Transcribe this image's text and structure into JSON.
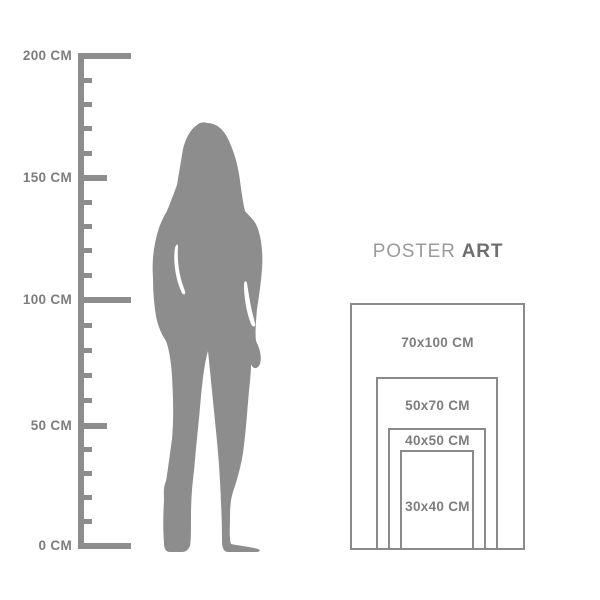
{
  "colors": {
    "shape_gray": "#8d8d8d",
    "rect_border_gray": "#8a8a8a",
    "label_text_gray": "#7d7d7d",
    "brand_regular_gray": "#9b9b9b",
    "brand_bold_gray": "#6e6e6e"
  },
  "ruler": {
    "unit": "CM",
    "max_cm": 200,
    "min_cm": 0,
    "labels": [
      {
        "value": 200,
        "text": "200 CM"
      },
      {
        "value": 150,
        "text": "150 CM"
      },
      {
        "value": 100,
        "text": "100 CM"
      },
      {
        "value": 50,
        "text": "50 CM"
      },
      {
        "value": 0,
        "text": "0 CM"
      }
    ]
  },
  "figure": {
    "icon": "woman-standing-silhouette"
  },
  "brand": {
    "regular": "POSTER",
    "bold": "ART"
  },
  "size_chart": {
    "sizes": [
      {
        "label": "70x100 CM",
        "width_cm": 70,
        "height_cm": 100
      },
      {
        "label": "50x70 CM",
        "width_cm": 50,
        "height_cm": 70
      },
      {
        "label": "40x50 CM",
        "width_cm": 40,
        "height_cm": 50
      },
      {
        "label": "30x40 CM",
        "width_cm": 30,
        "height_cm": 40
      }
    ]
  }
}
